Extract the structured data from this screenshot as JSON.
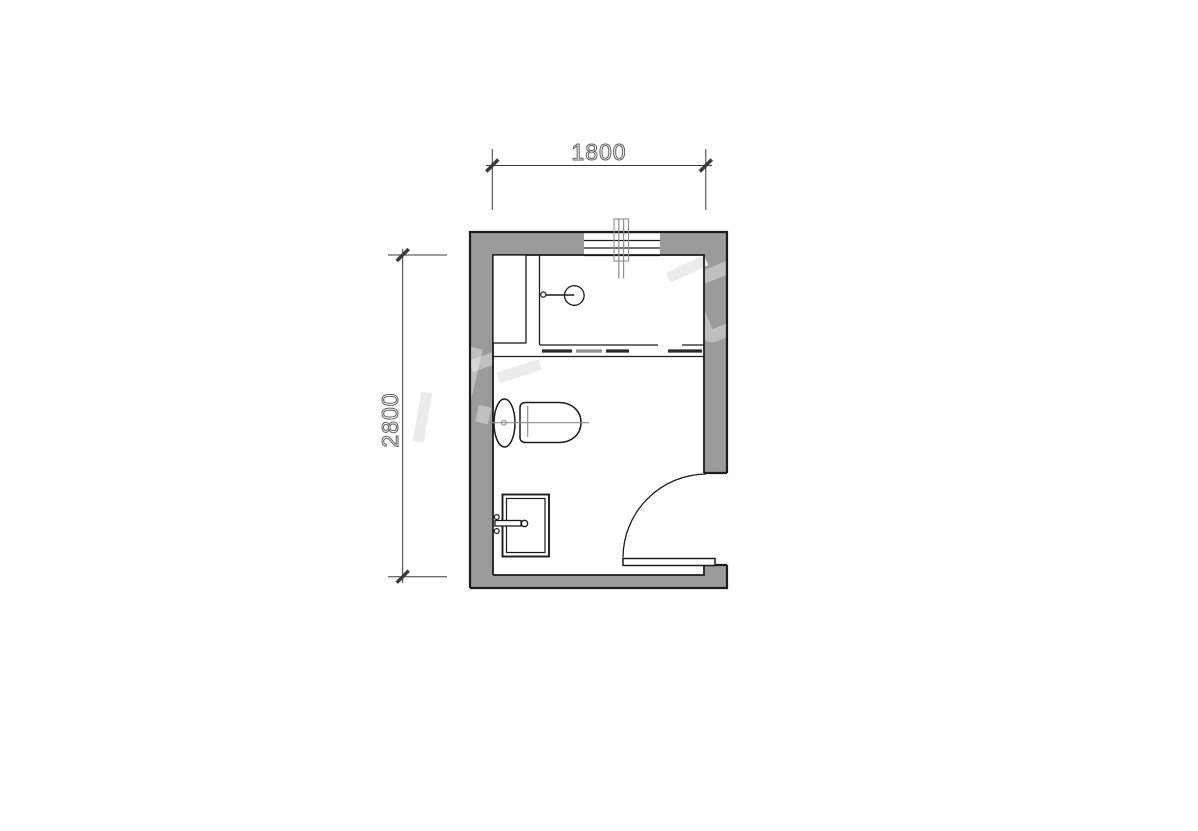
{
  "dimensions": {
    "top_label": "1800",
    "left_label": "2800"
  },
  "symbols": {
    "window": "window",
    "pipe": "pipe-riser",
    "shower_panel": "shower-side-panel",
    "shower_head": "shower-head",
    "curtain": "shower-partition",
    "toilet": "toilet",
    "sink": "sink",
    "door": "door-swing",
    "watermark": "watermark"
  },
  "colors": {
    "background": "#ffffff",
    "wall_fill": "#9b9b9b",
    "line": "#1c1c1c",
    "aux_line": "#8f8f8f",
    "dimension_line": "#3a3a3a",
    "dimension_text": "#5f5f5f",
    "watermark_on_wall": "rgba(255,255,255,0.36)",
    "watermark_on_white": "#ebebeb"
  }
}
